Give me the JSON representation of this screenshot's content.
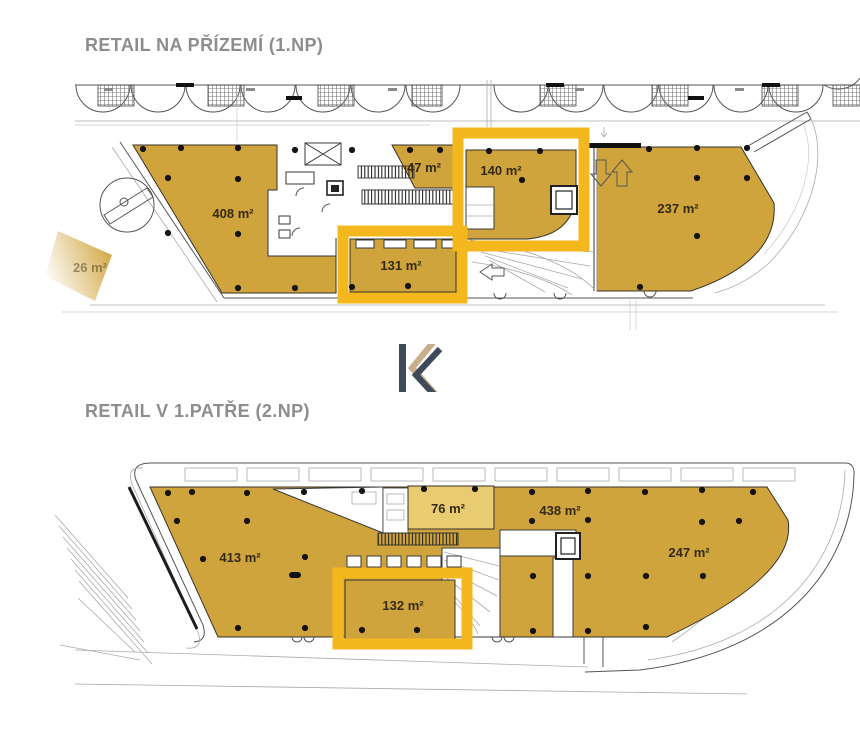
{
  "document": {
    "type": "retail-floor-plan-sheet",
    "language": "cs"
  },
  "colors": {
    "unit_fill": "#d0a43c",
    "unit_fill_light": "#e9cb72",
    "highlight_frame": "#f3b81d",
    "title_gray": "#8d8d8d",
    "label_dark": "#352915",
    "logo_dark": "#3e4a5a",
    "logo_tan": "#c8ae8c"
  },
  "plan1": {
    "title": "RETAIL NA PŘÍZEMÍ (1.NP)",
    "areas": [
      {
        "id": "unit-408",
        "label": "408 m²",
        "highlighted": false
      },
      {
        "id": "unit-47",
        "label": "47 m²",
        "highlighted": false
      },
      {
        "id": "unit-140",
        "label": "140 m²",
        "highlighted": true
      },
      {
        "id": "unit-237",
        "label": "237 m²",
        "highlighted": false
      },
      {
        "id": "unit-131",
        "label": "131 m²",
        "highlighted": true
      },
      {
        "id": "unit-26",
        "label": "26 m²",
        "highlighted": false,
        "faded": true
      }
    ]
  },
  "plan2": {
    "title": "RETAIL V 1.PATŘE (2.NP)",
    "areas": [
      {
        "id": "unit-413",
        "label": "413 m²",
        "highlighted": false
      },
      {
        "id": "unit-76",
        "label": "76 m²",
        "highlighted": false,
        "tone": "light"
      },
      {
        "id": "unit-438",
        "label": "438 m²",
        "highlighted": false
      },
      {
        "id": "unit-247",
        "label": "247 m²",
        "highlighted": false
      },
      {
        "id": "unit-132",
        "label": "132 m²",
        "highlighted": true
      }
    ]
  },
  "logo": {
    "monogram": "K"
  }
}
